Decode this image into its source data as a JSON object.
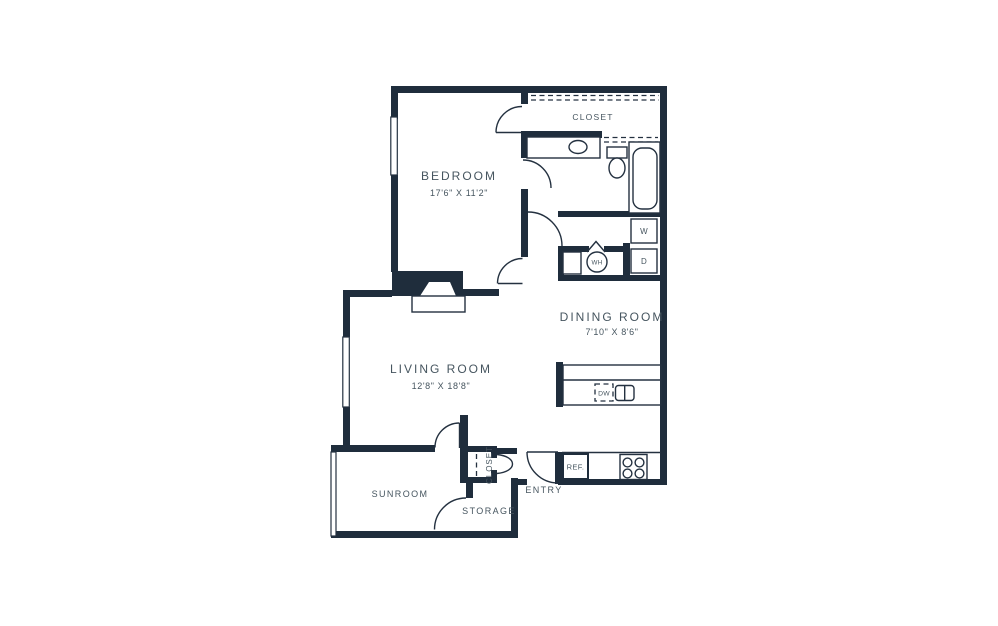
{
  "rooms": {
    "bedroom": {
      "label": "BEDROOM",
      "dims": "17'6\" X 11'2\""
    },
    "living_room": {
      "label": "LIVING ROOM",
      "dims": "12'8\" X 18'8\""
    },
    "dining_room": {
      "label": "DINING ROOM",
      "dims": "7'10\" X 8'6\""
    },
    "closet": {
      "label": "CLOSET"
    },
    "entry_closet": {
      "label": "CLOSET"
    },
    "sunroom": {
      "label": "SUNROOM"
    },
    "storage": {
      "label": "STORAGE"
    },
    "entry": {
      "label": "ENTRY"
    }
  },
  "fixtures": {
    "washer": "W",
    "dryer": "D",
    "water_heater": "WH",
    "dishwasher": "DW",
    "refrigerator": "REF."
  },
  "colors": {
    "wall": "#1f2d3c",
    "line": "#243140",
    "text": "#46555f",
    "background": "#ffffff"
  }
}
